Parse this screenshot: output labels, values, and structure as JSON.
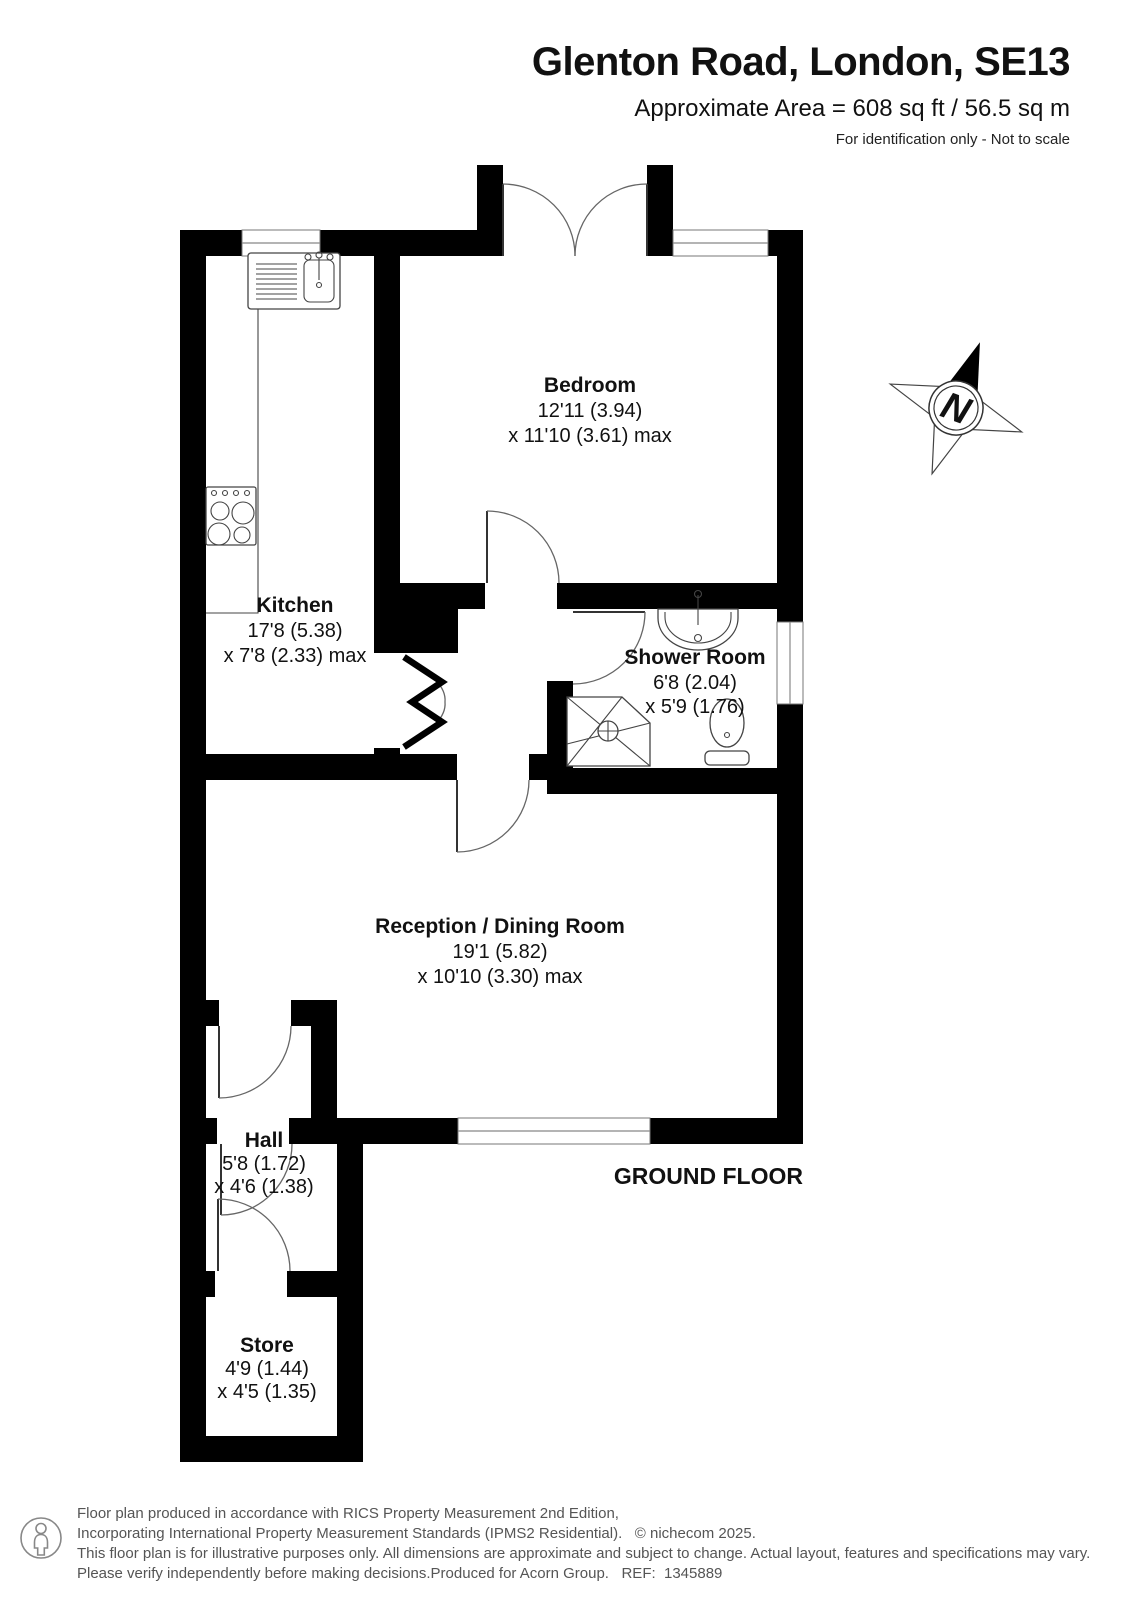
{
  "header": {
    "title": "Glenton Road, London, SE13",
    "area": "Approximate Area = 608 sq ft / 56.5 sq m",
    "note": "For identification only - Not to scale"
  },
  "plan": {
    "floor_label": "GROUND FLOOR"
  },
  "compass": {
    "letter": "N"
  },
  "rooms": [
    {
      "name": "Bedroom",
      "dim1": "12'11 (3.94)",
      "dim2": "x 11'10 (3.61) max"
    },
    {
      "name": "Kitchen",
      "dim1": "17'8 (5.38)",
      "dim2": "x 7'8 (2.33) max"
    },
    {
      "name": "Shower Room",
      "dim1": "6'8 (2.04)",
      "dim2": "x 5'9 (1.76)"
    },
    {
      "name": "Reception / Dining Room",
      "dim1": "19'1 (5.82)",
      "dim2": "x 10'10 (3.30) max"
    },
    {
      "name": "Hall",
      "dim1": "5'8 (1.72)",
      "dim2": "x 4'6 (1.38)"
    },
    {
      "name": "Store",
      "dim1": "4'9 (1.44)",
      "dim2": "x 4'5 (1.35)"
    }
  ],
  "footer": {
    "line1": "Floor plan produced in accordance with RICS Property Measurement 2nd Edition,",
    "line2": "Incorporating International Property Measurement Standards (IPMS2 Residential).   © nichecom 2025.",
    "line3": "This floor plan is for illustrative purposes only. All dimensions are approximate and subject to change. Actual layout, features and specifications may vary.",
    "line4": "Please verify independently before making decisions.Produced for Acorn Group.   REF:  1345889"
  },
  "colors": {
    "wall": "#000000",
    "window_line": "#888888",
    "footer_text": "#555555"
  }
}
